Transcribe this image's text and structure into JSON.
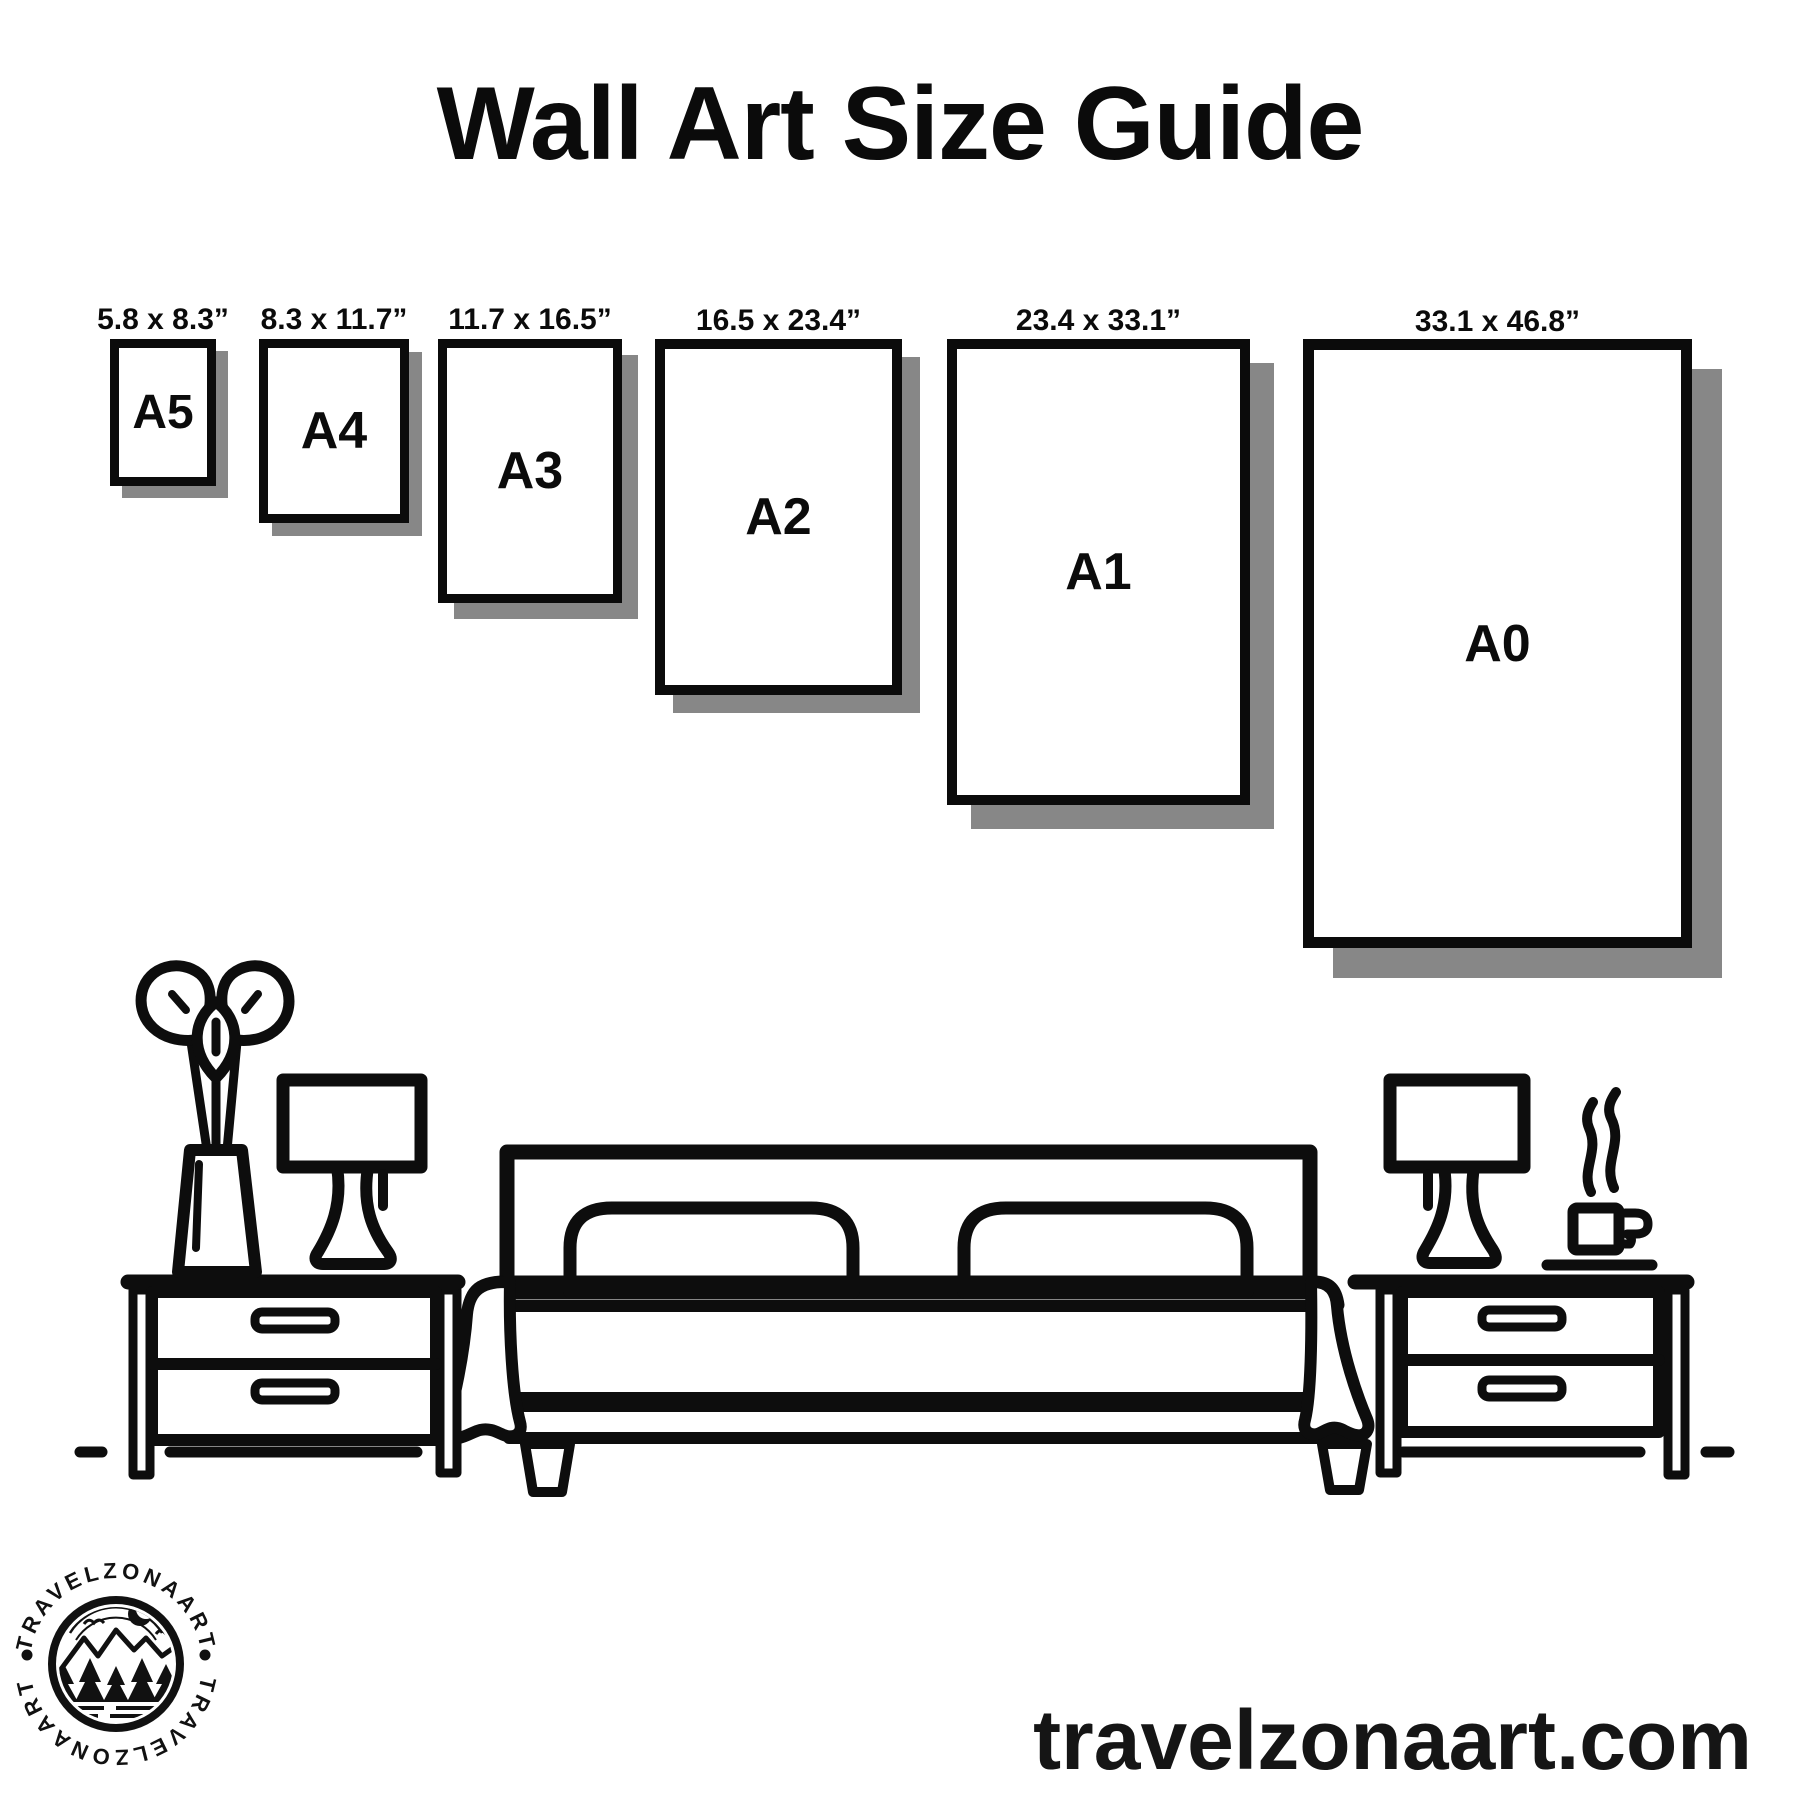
{
  "title": "Wall Art Size Guide",
  "frames": [
    {
      "name": "A5",
      "size_label": "5.8 x 8.3”"
    },
    {
      "name": "A4",
      "size_label": "8.3 x 11.7”"
    },
    {
      "name": "A3",
      "size_label": "11.7 x 16.5”"
    },
    {
      "name": "A2",
      "size_label": "16.5 x 23.4”"
    },
    {
      "name": "A1",
      "size_label": "23.4 x 33.1”"
    },
    {
      "name": "A0",
      "size_label": "33.1 x 46.8”"
    }
  ],
  "scene": {
    "icons": [
      "plant-vase-icon",
      "table-lamp-left-icon",
      "nightstand-left-icon",
      "double-bed-icon",
      "pillow-icon",
      "blanket-drape-icon",
      "nightstand-right-icon",
      "table-lamp-right-icon",
      "coffee-cup-icon",
      "steam-icon",
      "floor-line"
    ]
  },
  "logo": {
    "arc_text_top": "TRAVELZONAART",
    "arc_text_bottom": "TRAVELZONAART",
    "icons": [
      "mountain-icon",
      "crescent-moon-icon",
      "bird-icon",
      "pine-tree-icon",
      "water-icon"
    ]
  },
  "footer": {
    "website": "travelzonaart.com"
  },
  "colors": {
    "ink": "#0b0b0b",
    "shadow": "#878787",
    "background": "#ffffff"
  }
}
